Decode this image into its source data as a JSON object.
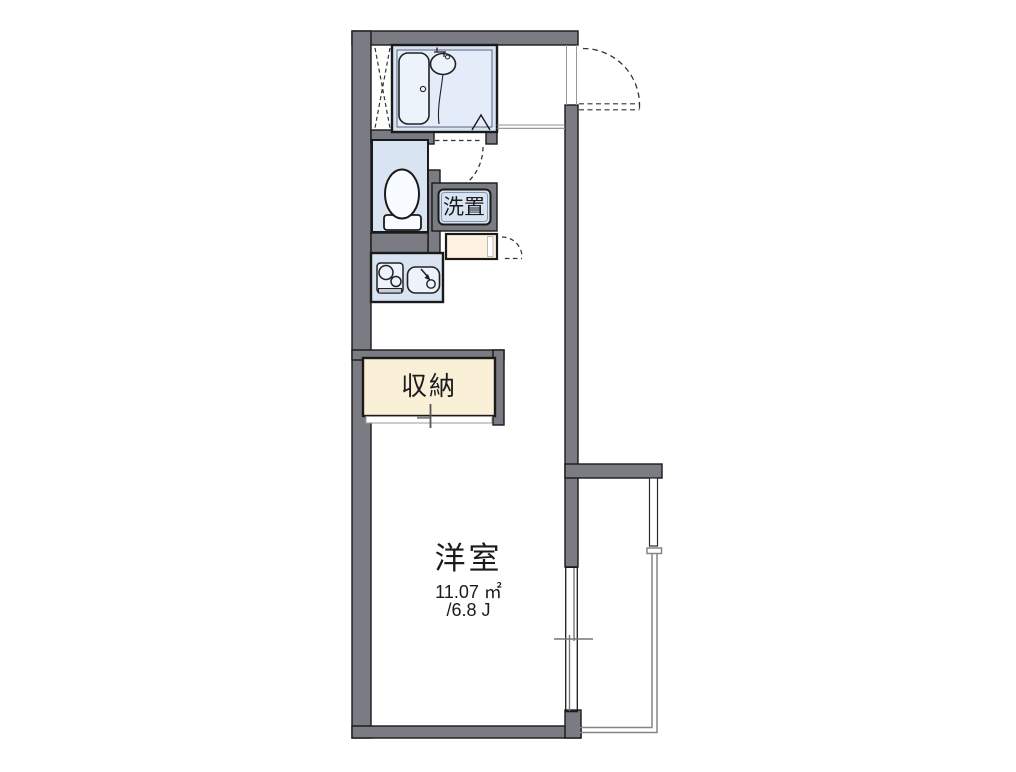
{
  "rooms": {
    "western_room": {
      "label": "洋室",
      "area_m2": "11.07 ㎡",
      "area_tatami": "/6.8 J"
    },
    "storage": {
      "label": "収納"
    },
    "washer_place": {
      "label": "洗置"
    }
  },
  "colors": {
    "wall_fill": "#7b7b83",
    "outline": "#1a1a1a",
    "wet_area_blue": "#d9e4f3",
    "bath_inner_blue": "#e3ecf8",
    "storage_cream": "#faf0d8",
    "counter_cream": "#fdf1e0",
    "railing_gray": "#868686",
    "door_swing_dash": "#333333"
  },
  "fixtures": [
    "bathtub-icon",
    "washbasin-icon",
    "shower-hose-icon",
    "toilet-icon",
    "stove-icon",
    "kitchen-sink-icon",
    "entrance-door-swing-icon",
    "bath-door-swing-icon",
    "cabinet-door-swing-icon",
    "sliding-window-icon",
    "storage-sliding-door-icon",
    "balcony-railing",
    "balcony-partition-panel",
    "genkan-step",
    "pipe-space-hatch"
  ]
}
